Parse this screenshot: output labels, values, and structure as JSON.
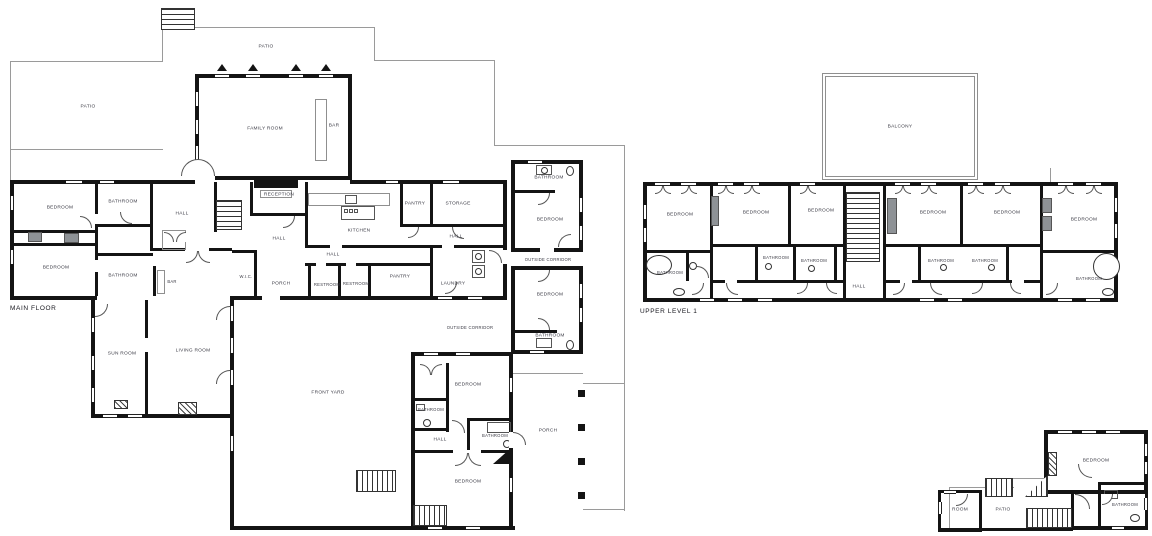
{
  "main_floor": {
    "title": "MAIN FLOOR",
    "rooms": [
      "PATIO",
      "PATIO",
      "FAMILY ROOM",
      "BAR",
      "BEDROOM",
      "BATHROOM",
      "HALL",
      "RECEPTION",
      "HALL",
      "KITCHEN",
      "PANTRY",
      "STORAGE",
      "HALL",
      "BEDROOM",
      "BATHROOM",
      "BAR",
      "W.I.C.",
      "PORCH",
      "HALL",
      "RESTROOM",
      "RESTROOM",
      "PANTRY",
      "LAUNDRY",
      "BATHROOM",
      "BEDROOM",
      "OUTSIDE CORRIDOR",
      "BEDROOM",
      "BATHROOM",
      "OUTSIDE CORRIDOR",
      "SUN ROOM",
      "LIVING ROOM",
      "FRONT YARD",
      "BEDROOM",
      "BATHROOM",
      "HALL",
      "BATHROOM",
      "BEDROOM",
      "PORCH"
    ]
  },
  "upper_level_1": {
    "title": "UPPER LEVEL 1",
    "rooms": [
      "BALCONY",
      "BEDROOM",
      "BEDROOM",
      "BEDROOM",
      "BATHROOM",
      "BATHROOM",
      "BATHROOM",
      "HALL",
      "BEDROOM",
      "BEDROOM",
      "BEDROOM",
      "BATHROOM",
      "BATHROOM",
      "BATHROOM"
    ]
  },
  "upper_level_2": {
    "rooms": [
      "BEDROOM",
      "BATHROOM",
      "ROOM",
      "PATIO"
    ]
  },
  "colors": {
    "wall": "#141414",
    "thin_line": "#9a9a9a",
    "label": "#3a3a44"
  }
}
